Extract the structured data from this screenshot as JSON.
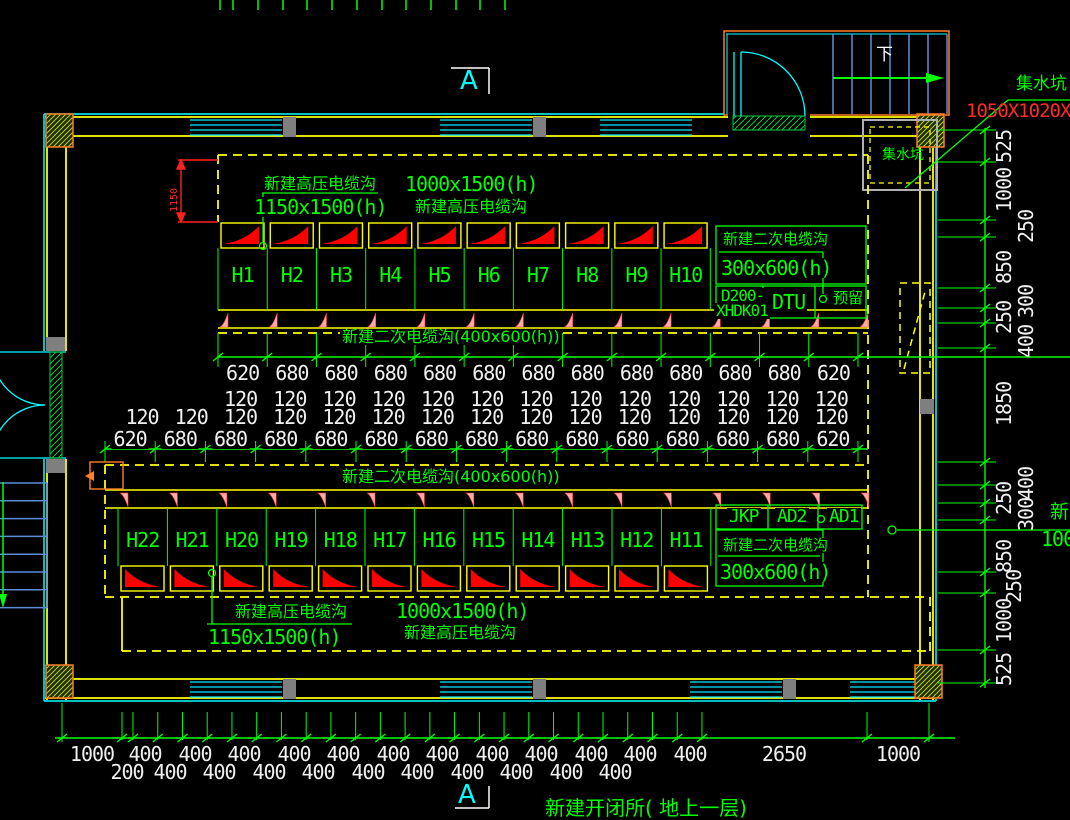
{
  "drawing": {
    "title": "新建开闭所( 地上一层)",
    "section_marker_top": "A",
    "section_marker_bottom": "A",
    "stair_down_label": "下"
  },
  "callouts": {
    "hv_top_name": "新建高压电缆沟",
    "hv_top_size": "1150x1500(h)",
    "hv_top2_size": "1000x1500(h)",
    "hv_top2_name": "新建高压电缆沟",
    "sec_small_top_name": "新建二次电缆沟",
    "sec_small_top_size": "300x600(h)",
    "d200_line1": "D200-",
    "d200_line2": "XHDK01",
    "dtu": "DTU",
    "reserved": "预留",
    "sec_mid_top": "新建二次电缆沟(400x600(h))",
    "sec_mid_bottom": "新建二次电缆沟(400x600(h))",
    "jkp": "JKP",
    "ad2": "AD2",
    "ad1": "AD1",
    "sec_small_bottom_name": "新建二次电缆沟",
    "sec_small_bottom_size": "300x600(h)",
    "hv_bottom_name": "新建高压电缆沟",
    "hv_bottom_size": "1150x1500(h)",
    "hv_bottom2_size": "1000x1500(h)",
    "hv_bottom2_name": "新建高压电缆沟",
    "sump_pit_callout": "集水坑",
    "sump_pit_size": "1050X1020X",
    "sump_pit_inside": "集水坑",
    "trench_width_dim": "1150",
    "right_edge_partial_text": "新",
    "right_edge_partial_dim": "100"
  },
  "cabinets": {
    "top_row": [
      "H1",
      "H2",
      "H3",
      "H4",
      "H5",
      "H6",
      "H7",
      "H8",
      "H9",
      "H10"
    ],
    "bottom_row": [
      "H22",
      "H21",
      "H20",
      "H19",
      "H18",
      "H17",
      "H16",
      "H15",
      "H14",
      "H13",
      "H12",
      "H11"
    ]
  },
  "dimensions": {
    "mid_top_chain": [
      "620",
      "680",
      "680",
      "680",
      "680",
      "680",
      "680",
      "680",
      "680",
      "680",
      "680",
      "680",
      "620"
    ],
    "gap_row_upper": [
      "120",
      "120",
      "120",
      "120",
      "120",
      "120",
      "120",
      "120",
      "120",
      "120",
      "120",
      "120",
      "120"
    ],
    "gap_row_lower": [
      "120",
      "120",
      "120",
      "120",
      "120",
      "120",
      "120",
      "120",
      "120",
      "120",
      "120",
      "120",
      "120",
      "120",
      "120"
    ],
    "mid_bottom_chain": [
      "620",
      "680",
      "680",
      "680",
      "680",
      "680",
      "680",
      "680",
      "680",
      "680",
      "680",
      "680",
      "680",
      "680",
      "620"
    ],
    "bottom_chain_upper": [
      "1000",
      "400",
      "400",
      "400",
      "400",
      "400",
      "400",
      "400",
      "400",
      "400",
      "400",
      "400",
      "400",
      "2650",
      "1000"
    ],
    "bottom_chain_lower": [
      "200",
      "400",
      "400",
      "400",
      "400",
      "400",
      "400",
      "400",
      "400",
      "400",
      "400"
    ],
    "right_chain": [
      "525",
      "1000",
      "250",
      "850",
      "300",
      "250",
      "400",
      "1850",
      "400",
      "250",
      "300",
      "850",
      "250",
      "1000",
      "525"
    ]
  },
  "colors": {
    "background": "#000000",
    "line_green": "#00ff00",
    "line_yellow": "#ffff00",
    "line_cyan": "#00ffff",
    "window_cyan": "#00e5ff",
    "cabinet_red": "#ff0000",
    "mark_pink": "#ffabab",
    "callout_red": "#ff2a2a",
    "stair_blue": "#5b8dd9",
    "wall_orange": "#ff7f27",
    "dim_text": "#f0f0f0"
  }
}
